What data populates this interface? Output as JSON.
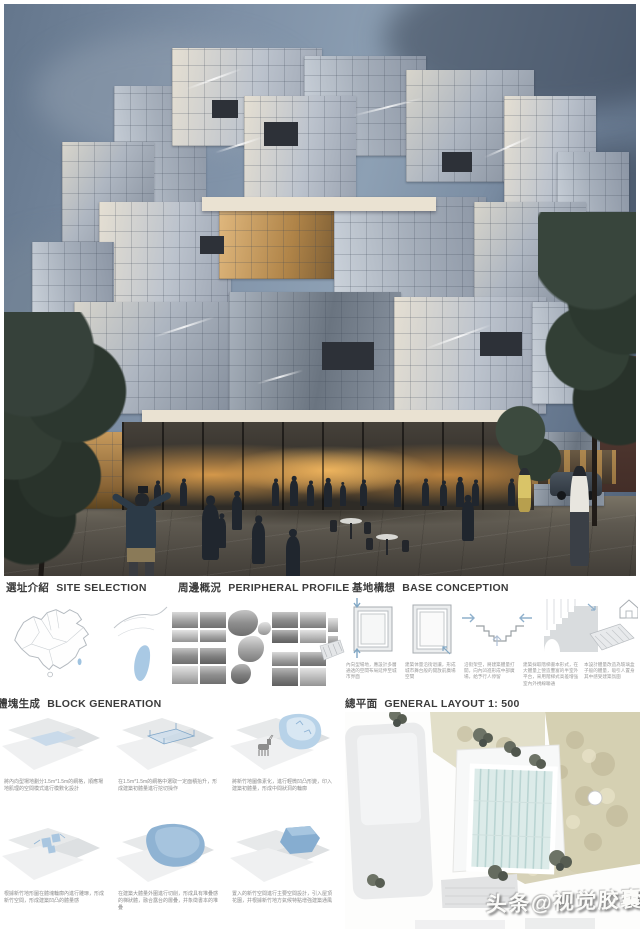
{
  "poster": {
    "sections": {
      "site_selection": {
        "zh": "選址介紹",
        "en": "SITE SELECTION"
      },
      "peripheral_profile": {
        "zh": "周邊概況",
        "en": "PERIPHERAL PROFILE"
      },
      "base_conception": {
        "zh": "基地構想",
        "en": "BASE CONCEPTION"
      },
      "block_generation": {
        "zh": "體塊生成",
        "en": "BLOCK GENERATION"
      },
      "general_layout": {
        "zh": "總平面",
        "en": "GENERAL LAYOUT 1: 500"
      }
    },
    "base_conception_captions": [
      "內向型場地，應設計多層通透的空間布局延伸至城市界面",
      "建築体量沿街退讓，形成城市舞台般的開放前廣場空間",
      "沿街架空，將建築體量打開，向內凹進形成中部廣場，給予行人停留",
      "建築採取階梯書本形式，在大體量上營造豐富的半室外平台，采用階梯式高差增強室內外視線聯通",
      "本設計體量改造為玻璃盒子般的體量，吸引人置身其中感受建築氛圍"
    ],
    "block_generation_captions": [
      "將內向型場地劃分1.5m*1.5m的網格，順應場地肌理的空間模式進行模數化設計",
      "在1.5m*1.5m的網格中選取一定面積抬升，形成建築初體量進行挖切操作",
      "將新竹地圖像素化，進行輕微凹凸形變，印入建築初體量，形成中間狀洞的輪廓",
      "根據新竹地形圖在體塊輪廓內進行雕琢，形成新竹空間，形成建築凹凸的體量感",
      "在建築大體量外圍進行切削，形成具有堆疊感的梯狀體，融合露台的層疊，并象徵書本的堆疊",
      "置入的新竹空間進行主要空間設計，引入屋頂花園，并根據新竹地方氣候特點增強建築通風"
    ],
    "watermark": "头条@视觉胶囊",
    "colors": {
      "sky": "#78899e",
      "accent_blue": "#a9c9e4",
      "plan_landscape": "#d2cdb0",
      "heading_text": "#3b3b3b"
    }
  }
}
